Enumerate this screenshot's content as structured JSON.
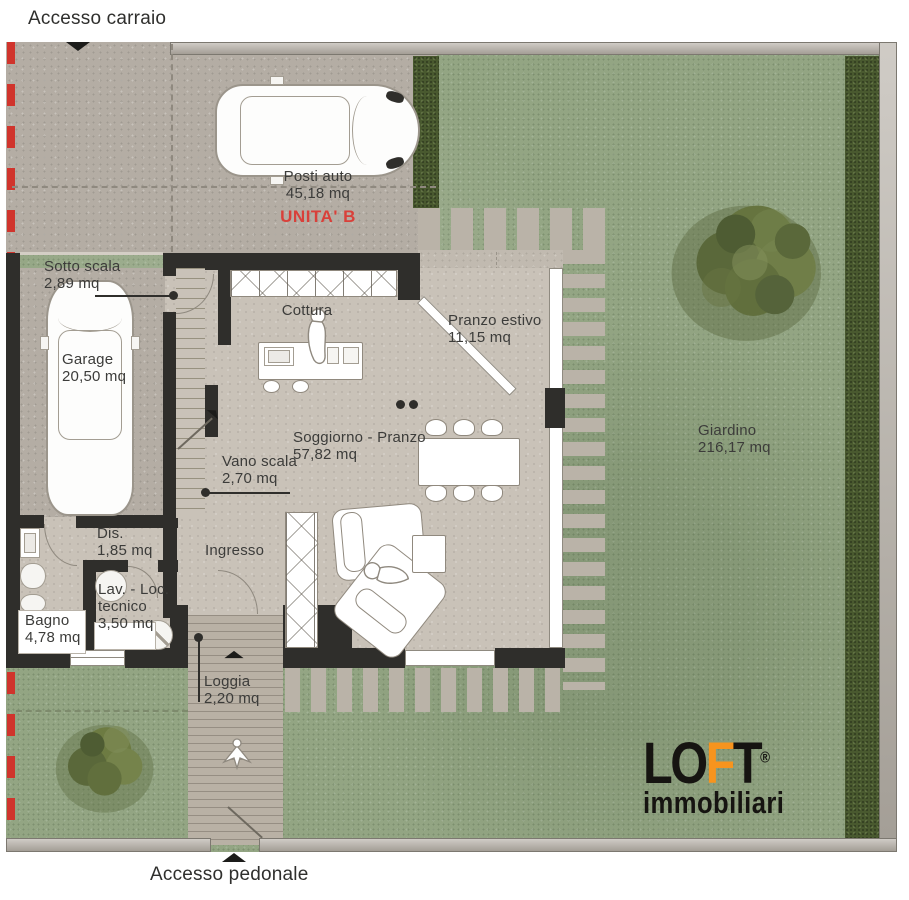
{
  "annotations": {
    "accesso_carraio": "Accesso carraio",
    "accesso_pedonale": "Accesso pedonale",
    "unit": "UNITA' B"
  },
  "areas": [
    {
      "label": "Posti auto",
      "area": "45,18 mq"
    },
    {
      "label": "Sotto scala",
      "area": "2,89 mq"
    },
    {
      "label": "Garage",
      "area": "20,50 mq"
    },
    {
      "label": "Cottura",
      "area": ""
    },
    {
      "label": "Pranzo estivo",
      "area": "11,15 mq"
    },
    {
      "label": "Soggiorno - Pranzo",
      "area": "57,82 mq"
    },
    {
      "label": "Vano scala",
      "area": "2,70 mq"
    },
    {
      "label": "Giardino",
      "area": "216,17 mq"
    },
    {
      "label": "Dis.",
      "area": "1,85 mq"
    },
    {
      "label": "Ingresso",
      "area": ""
    },
    {
      "label": "Lav. - Loc.",
      "label2": "tecnico",
      "area": "3,50 mq"
    },
    {
      "label": "Bagno",
      "area": "4,78 mq"
    },
    {
      "label": "Loggia",
      "area": "2,20 mq"
    }
  ],
  "logo": {
    "part1": "LO",
    "part2": "F",
    "part3": "T",
    "reg": "®",
    "sub": "immobiliari"
  },
  "colors": {
    "unit_red": "#d9403a",
    "logo_orange": "#f7941e",
    "wall_dark": "#2f2e2b",
    "grass_green": "#93a583",
    "concrete": "#b4ada4",
    "property_line_red": "#d0342c"
  }
}
